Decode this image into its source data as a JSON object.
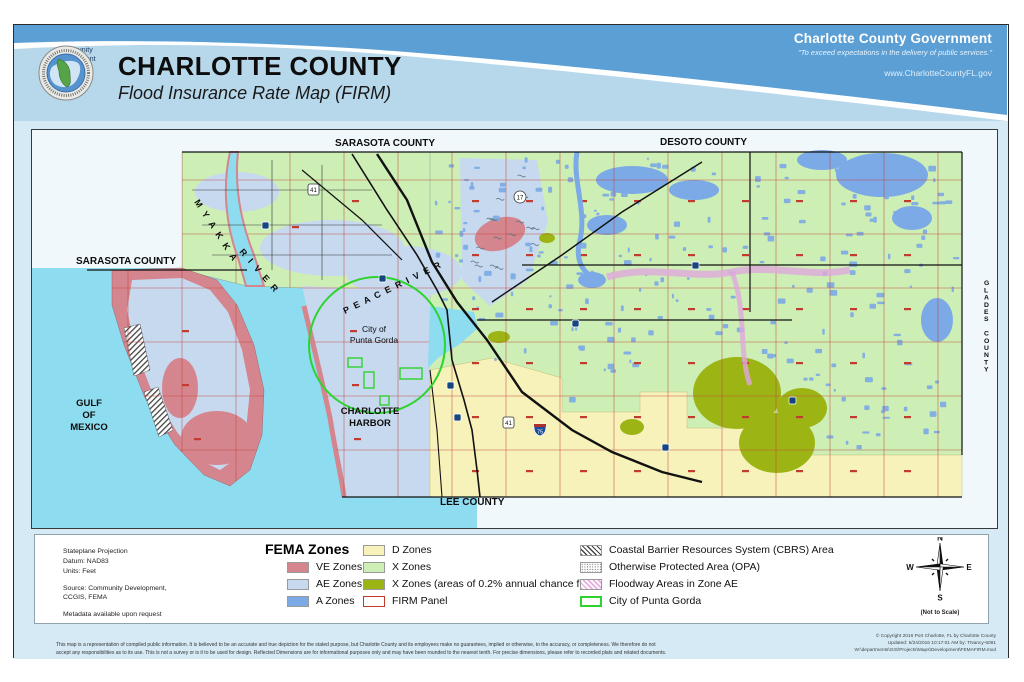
{
  "header": {
    "title": "CHARLOTTE COUNTY",
    "subtitle": "Flood Insurance Rate Map (FIRM)",
    "logo_caption": "Community Development",
    "gov_name": "Charlotte County Government",
    "gov_tagline": "\"To exceed expectations in the delivery of public services.\"",
    "gov_url": "www.CharlotteCountyFL.gov"
  },
  "map": {
    "labels": {
      "sarasota_top": "SARASOTA COUNTY",
      "sarasota_left": "SARASOTA COUNTY",
      "desoto": "DESOTO COUNTY",
      "glades": "GLADES COUNTY",
      "lee": "LEE COUNTY",
      "gulf_1": "GULF",
      "gulf_2": "OF",
      "gulf_3": "MEXICO",
      "harbor_1": "CHARLOTTE",
      "harbor_2": "HARBOR",
      "punta_1": "City of",
      "punta_2": "Punta Gorda",
      "myakka": "M Y A K K A",
      "myakka_river": "R I V E R",
      "peace_river": "P E A C E   R I V E R"
    },
    "route_shields": {
      "us41": "41",
      "us17": "17",
      "i75": "75"
    }
  },
  "legend": {
    "title": "FEMA Zones",
    "info": {
      "projection_lines": [
        "Stateplane Projection",
        "Datum: NAD83",
        "Units:  Feet"
      ],
      "source_lines": [
        "Source: Community Development,",
        "CCGIS, FEMA"
      ],
      "metadata": "Metadata available upon request"
    },
    "items": [
      {
        "label": "VE Zones",
        "color": "#d5858e"
      },
      {
        "label": "AE Zones",
        "color": "#c6d9ef"
      },
      {
        "label": "A Zones",
        "color": "#7baae6"
      },
      {
        "label": "D Zones",
        "color": "#f6f2ba"
      },
      {
        "label": "X Zones",
        "color": "#cdeeb5"
      },
      {
        "label": "X Zones (areas of 0.2% annual chance flood)",
        "color": "#9cb515"
      },
      {
        "label": "FIRM Panel",
        "color": "#ffffff",
        "border": "#c0392b",
        "border_w": 1
      },
      {
        "label": "Coastal Barrier Resources System (CBRS) Area",
        "pattern": "hatch-dark"
      },
      {
        "label": "Otherwise Protected Area (OPA)",
        "pattern": "dots"
      },
      {
        "label": "Floodway Areas in Zone AE",
        "pattern": "hatch-pink"
      },
      {
        "label": "City of Punta Gorda",
        "color": "#ffffff",
        "border": "#2fd32f",
        "border_w": 2
      }
    ],
    "compass": {
      "n": "N",
      "e": "E",
      "s": "S",
      "w": "W",
      "note": "(Not to Scale)"
    }
  },
  "footer": {
    "disclaimer_line1": "This map is a representation of compiled public information.  It is believed to be an accurate and true depiction for the stated purpose, but Charlotte County and its employees make no guarantees, implied or otherwise, to the accuracy, or completeness.  We therefore do not",
    "disclaimer_line2": "accept any responsibilities as to its use.  This is not a survey or is it to be used for design.  Reflected Dimensions are for informational purposes only and may have been rounded to the nearest tenth.  For precise dimensions, please refer to recorded plats and related documents.",
    "copyright_lines": [
      "© Copyright 2016 Port Charlotte, FL by Charlotte County",
      "Updated: 5/24/2016 10:17:01 AM   by:  TNancy-5091",
      "W:\\departments\\GIS\\Projects\\Maps\\Development\\FEMAFIRM.mxd"
    ]
  }
}
